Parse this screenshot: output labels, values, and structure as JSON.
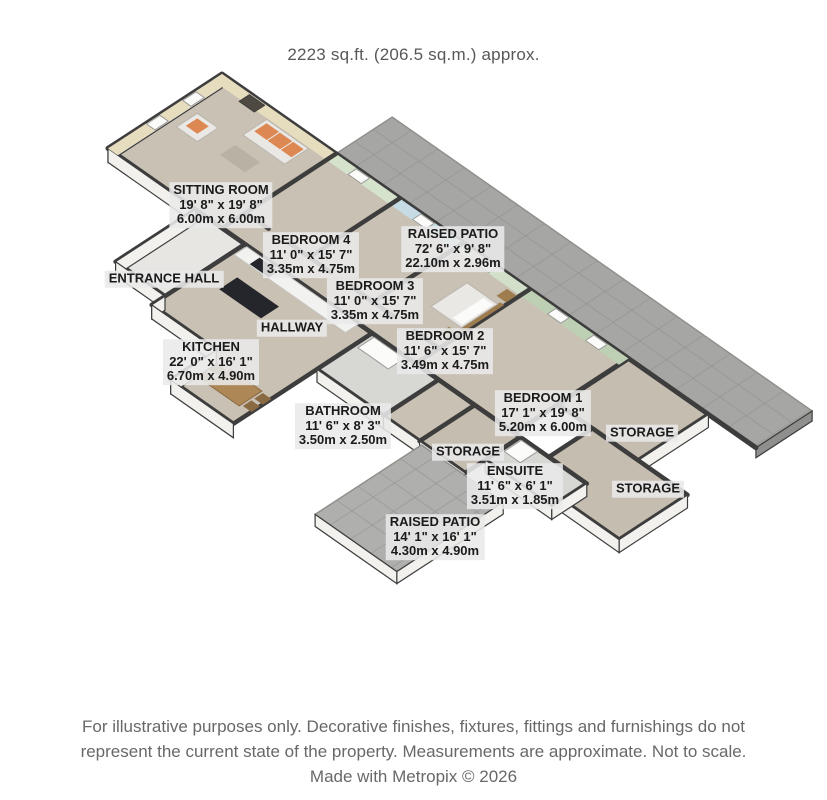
{
  "title": {
    "area_text": "2223 sq.ft. (206.5 sq.m.) approx."
  },
  "footer": {
    "line1": "For illustrative purposes only. Decorative finishes, fixtures, fittings and furnishings do not",
    "line2": "represent the current state of the property. Measurements are approximate. Not to scale.",
    "line3": "Made with Metropix © 2026"
  },
  "rooms": [
    {
      "id": "sitting-room",
      "name": "SITTING ROOM",
      "dims_ft": "19' 8\" x 19' 8\"",
      "dims_m": "6.00m x 6.00m"
    },
    {
      "id": "bedroom-4",
      "name": "BEDROOM 4",
      "dims_ft": "11' 0\" x 15' 7\"",
      "dims_m": "3.35m x 4.75m"
    },
    {
      "id": "raised-patio-top",
      "name": "RAISED PATIO",
      "dims_ft": "72' 6\" x 9' 8\"",
      "dims_m": "22.10m x 2.96m"
    },
    {
      "id": "bedroom-3",
      "name": "BEDROOM 3",
      "dims_ft": "11' 0\" x 15' 7\"",
      "dims_m": "3.35m x 4.75m"
    },
    {
      "id": "entrance-hall",
      "name": "ENTRANCE HALL",
      "dims_ft": "",
      "dims_m": ""
    },
    {
      "id": "hallway",
      "name": "HALLWAY",
      "dims_ft": "",
      "dims_m": ""
    },
    {
      "id": "bedroom-2",
      "name": "BEDROOM 2",
      "dims_ft": "11' 6\" x 15' 7\"",
      "dims_m": "3.49m x 4.75m"
    },
    {
      "id": "kitchen",
      "name": "KITCHEN",
      "dims_ft": "22' 0\" x 16' 1\"",
      "dims_m": "6.70m x 4.90m"
    },
    {
      "id": "bedroom-1",
      "name": "BEDROOM 1",
      "dims_ft": "17' 1\" x 19' 8\"",
      "dims_m": "5.20m x 6.00m"
    },
    {
      "id": "storage-ne",
      "name": "STORAGE",
      "dims_ft": "",
      "dims_m": ""
    },
    {
      "id": "bathroom",
      "name": "BATHROOM",
      "dims_ft": "11' 6\" x 8' 3\"",
      "dims_m": "3.50m x 2.50m"
    },
    {
      "id": "storage-mid",
      "name": "STORAGE",
      "dims_ft": "",
      "dims_m": ""
    },
    {
      "id": "ensuite",
      "name": "ENSUITE",
      "dims_ft": "11' 6\" x 6' 1\"",
      "dims_m": "3.51m x 1.85m"
    },
    {
      "id": "storage-se",
      "name": "STORAGE",
      "dims_ft": "",
      "dims_m": ""
    },
    {
      "id": "raised-patio-bottom",
      "name": "RAISED PATIO",
      "dims_ft": "14' 1\" x 16' 1\"",
      "dims_m": "4.30m x 4.90m"
    }
  ],
  "palette": {
    "wall": "#3d3d3d",
    "whiteWall": "#f2f1ee",
    "carpet": "#c9c1b3",
    "patio": "#a6a6a4",
    "patioLight": "#afafad",
    "patioSide": "#8f8f8d",
    "patioEdge": "#90908c",
    "storageFloor": "#c5bdb0",
    "entranceFloor": "#e7e6e3",
    "bathFloor": "#d7d7d4",
    "accentSitting": "#e6dcbe",
    "accentBed4": "#d5e2cc",
    "accentBed3": "#c7dbe4",
    "accentBed2": "#d2e0c9",
    "accentBed1": "#bed0b4",
    "window": "#fbfbf9",
    "winFrame": "#9b9b99",
    "sofa": "#eae8e4",
    "sofaEdge": "#b9b6af",
    "cushion": "#dd8752",
    "table": "#b8b1a4",
    "fire": "#4e4a42",
    "counter": "#f2f2f0",
    "counterEdge": "#c5c4c0",
    "island": "#25262b",
    "tableTop": "#ad8755",
    "wood": "#9e7c4e",
    "woodDark": "#8a6a42"
  }
}
